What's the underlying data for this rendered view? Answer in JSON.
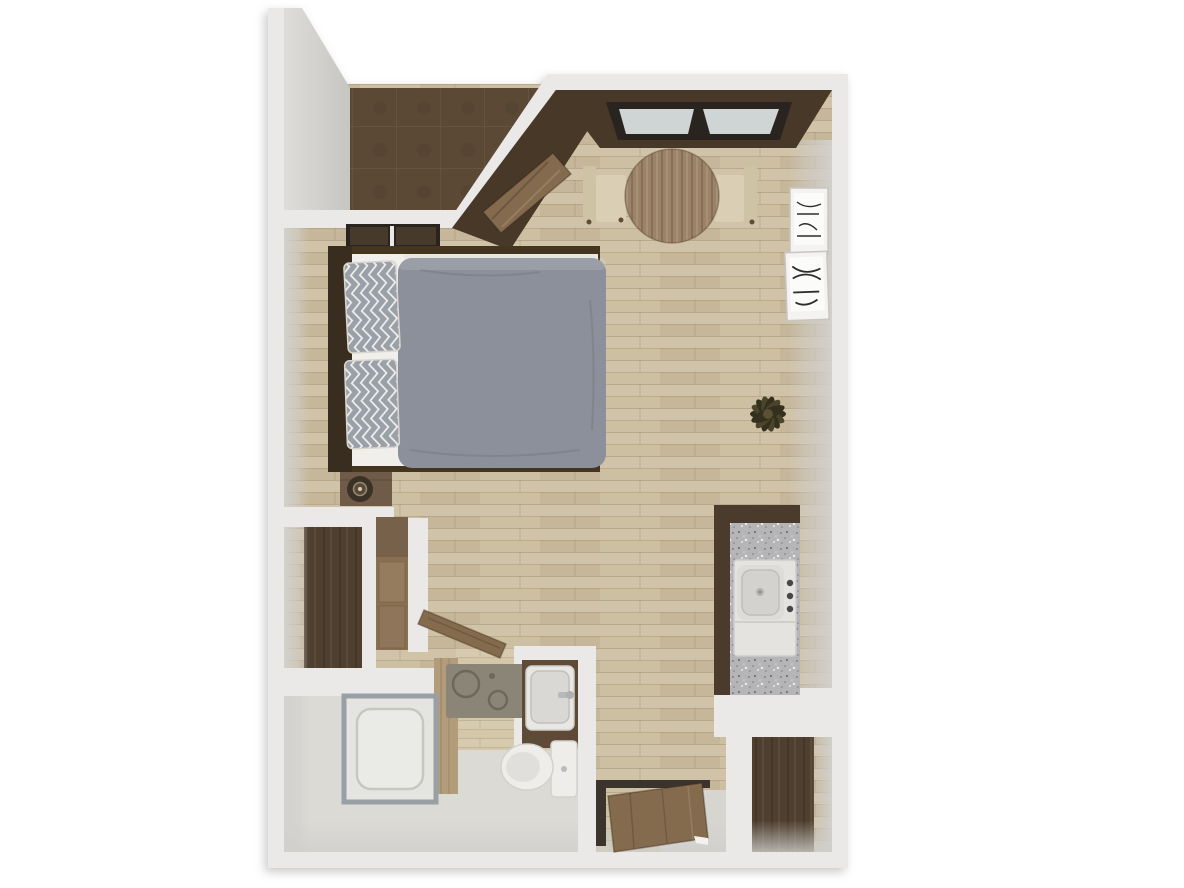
{
  "meta": {
    "description": "3D top-down rendered floor plan of a studio apartment",
    "view": "bird's-eye 3D render",
    "visible_text": ""
  },
  "palette": {
    "bg": "#ffffff",
    "wall": "#eae9e7",
    "faceGray": "#d3d2cf",
    "faceGrayDark": "#c6c5c1",
    "floorWood": "#cdbfa2",
    "floorWoodLight": "#d3c6a9",
    "patioTile": "#5b4936",
    "accentDark": "#473828",
    "frameDark": "#292420",
    "glass": "#cfd4d4",
    "bedWindowPane": "#463a2b",
    "doorWood": "#856b4e",
    "headboard": "#392d20",
    "bedFrame": "#43351f",
    "mattress": "#e9e7e3",
    "sheet": "#f1efeb",
    "pillowBase": "#f2f0ec",
    "pillowStripe": "#9aa0a8",
    "duvet": "#8c909a",
    "nightstand": "#6f5b48",
    "trayDark": "#3a3127",
    "tableWood": "#9c8367",
    "chairWood": "#cfc3a6",
    "chairSeat": "#dacfb4",
    "granite": "#b5b5b7",
    "sinkWhite": "#e4e3df",
    "basinGray": "#d3d2ce",
    "knobDark": "#47464a",
    "cabinetDark": "#4b3b2c",
    "closetFloor": "#4f3f2e",
    "wardrobeWood": "#8a7051",
    "wardrobeTop": "#77614a",
    "wardrobePanel": "#967c5e",
    "tileGray": "#dbdad5",
    "bathWoodWall": "#b29c79",
    "rugBase": "#8b8577",
    "rugPattern": "#6e6859",
    "toiletWhite": "#eeedea",
    "showerFrame": "#99a0a5",
    "showerBase": "#e4e4e0",
    "vanityWood": "#5e4a37",
    "plantDark": "#33301f",
    "plantMid": "#4a4429",
    "plantCenter": "#5a5233",
    "artFrame": "#f4f3f1",
    "artPaper": "#fbfbfa",
    "artInk": "#2e2d2b",
    "thresholdDark": "#3b342c",
    "nookGray": "#d6d5d0"
  },
  "rooms": [
    {
      "name": "patio-entry-alcove",
      "floor": "dark brown tile"
    },
    {
      "name": "dining-area",
      "floor": "light wood plank"
    },
    {
      "name": "sleeping-area",
      "floor": "light wood plank"
    },
    {
      "name": "kitchenette",
      "floor": "light wood plank"
    },
    {
      "name": "bathroom",
      "floor": "wood tile + gray tile"
    },
    {
      "name": "shower-nook",
      "floor": "gray tile"
    },
    {
      "name": "closet-left",
      "floor": "dark wood"
    },
    {
      "name": "closet-entry",
      "floor": "dark wood"
    },
    {
      "name": "entry-nook",
      "floor": "wood + gray tile"
    }
  ],
  "furniture": [
    {
      "name": "dining-window",
      "count": 1,
      "detail": "two-pane window in dark accent wall"
    },
    {
      "name": "round-dining-table",
      "count": 1,
      "detail": "wood, two cream chairs"
    },
    {
      "name": "wall-art",
      "count": 2,
      "detail": "black and white sketches in white frames"
    },
    {
      "name": "double-bed",
      "count": 1,
      "detail": "gray duvet, two chevron pillows, dark headboard"
    },
    {
      "name": "bedroom-window",
      "count": 1,
      "detail": "above headboard wall"
    },
    {
      "name": "nightstand",
      "count": 1,
      "detail": "wood with round tray decor"
    },
    {
      "name": "wardrobe",
      "count": 1,
      "detail": "wood cabinet"
    },
    {
      "name": "kitchen-counter",
      "count": 1,
      "detail": "granite top, dark cabinet, sink with three knobs"
    },
    {
      "name": "potted-plant",
      "count": 1,
      "detail": "dark spiky plant"
    },
    {
      "name": "shower",
      "count": 1,
      "detail": "white tray with metal frame"
    },
    {
      "name": "bath-rug",
      "count": 1,
      "detail": "gray with circle pattern"
    },
    {
      "name": "vanity-sink",
      "count": 1,
      "detail": "white basin in dark wood counter"
    },
    {
      "name": "toilet",
      "count": 1,
      "detail": "white, tank right"
    },
    {
      "name": "interior-doors",
      "count": 3,
      "detail": "patio door, bathroom door, entry door (open)"
    }
  ]
}
